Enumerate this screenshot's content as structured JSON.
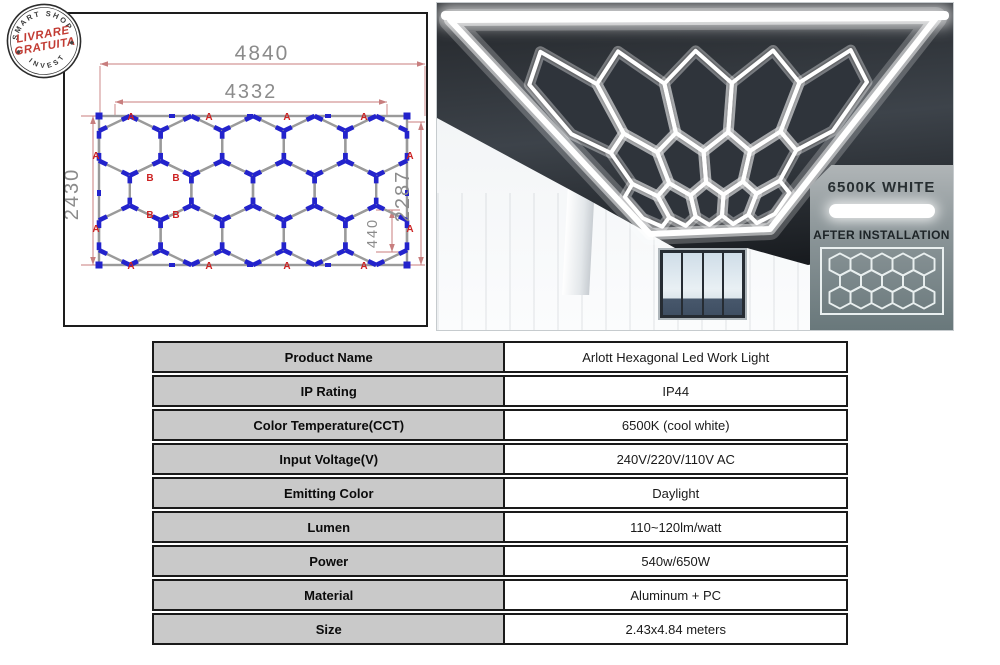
{
  "stamp": {
    "arc_top": "SMART SHOP",
    "line1": "LIVRARE",
    "line2": "GRATUITA",
    "arc_bottom": "INVEST"
  },
  "diagram": {
    "outer_width": "4840",
    "inner_width": "4332",
    "outer_height": "2430",
    "inner_height": "2287",
    "hex_size": "440",
    "marker_a": "A",
    "marker_b": "B"
  },
  "photo": {
    "color_temp_label": "6500K WHITE",
    "after_install_label": "AFTER INSTALLATION"
  },
  "table": {
    "rows": [
      {
        "label": "Product Name",
        "value": "Arlott Hexagonal Led Work Light"
      },
      {
        "label": "IP Rating",
        "value": "IP44"
      },
      {
        "label": "Color Temperature(CCT)",
        "value": "6500K (cool white)"
      },
      {
        "label": "Input Voltage(V)",
        "value": "240V/220V/110V AC"
      },
      {
        "label": "Emitting Color",
        "value": "Daylight"
      },
      {
        "label": "Lumen",
        "value": "110~120lm/watt"
      },
      {
        "label": "Power",
        "value": "540w/650W"
      },
      {
        "label": "Material",
        "value": "Aluminum + PC"
      },
      {
        "label": "Size",
        "value": "2.43x4.84 meters"
      }
    ]
  },
  "colors": {
    "dim_red": "#c87e7e",
    "marker_red": "#cc2222",
    "connector_blue": "#2323cc",
    "tube_gray": "#9a9a9a",
    "dim_text_gray": "#8b8b8b",
    "glow_white": "#ffffff",
    "panel_line": "#e9efef",
    "label_cell_bg": "#c9c9c9",
    "stamp_red": "#c23b33"
  }
}
